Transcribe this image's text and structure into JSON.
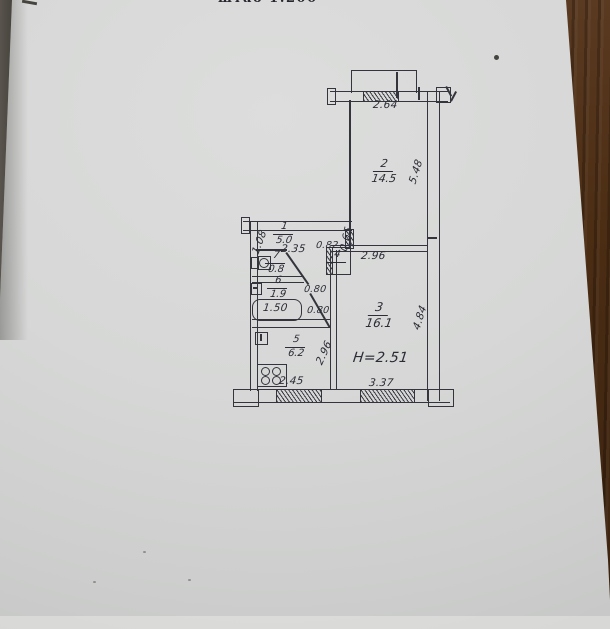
{
  "scale_note": "штаб 1:200",
  "plan": {
    "rooms": {
      "hall": {
        "number": "1",
        "area": "5.0"
      },
      "room2": {
        "number": "2",
        "area": "14.5"
      },
      "room3": {
        "number": "3",
        "area": "16.1"
      },
      "closet": {
        "number": "4"
      },
      "kitchen": {
        "number": "5",
        "area": "6.2"
      },
      "bath": {
        "number": "6",
        "area": "1.9"
      },
      "wc": {
        "number": "7",
        "area": "0.8"
      }
    },
    "dims": {
      "balcony_window": "2.64",
      "room2_depth": "5.48",
      "hall_left": "1.08",
      "hall_width": "2.35",
      "hall_right": "0.65",
      "closet_door": "0.82",
      "wc_door": "0.80",
      "bath_door": "0.80",
      "tub_length": "1.50",
      "kitchen_width": "2.45",
      "kitchen_depth": "2.96",
      "room3_width_top": "2.96",
      "room3_depth": "4.84",
      "room3_width_bottom": "3.37",
      "ceiling_height": "H=2.51"
    },
    "icons": {
      "toilet": "toilet-plan-symbol",
      "sink": "sink-plan-symbol",
      "bathtub": "bathtub-plan-symbol",
      "vent": "vent-shaft-symbol",
      "stove": "stove-4-burner-symbol"
    },
    "colors": {
      "ink": "#34343c",
      "paper": "#d5d6d5",
      "wood": "#4a2c13"
    }
  }
}
